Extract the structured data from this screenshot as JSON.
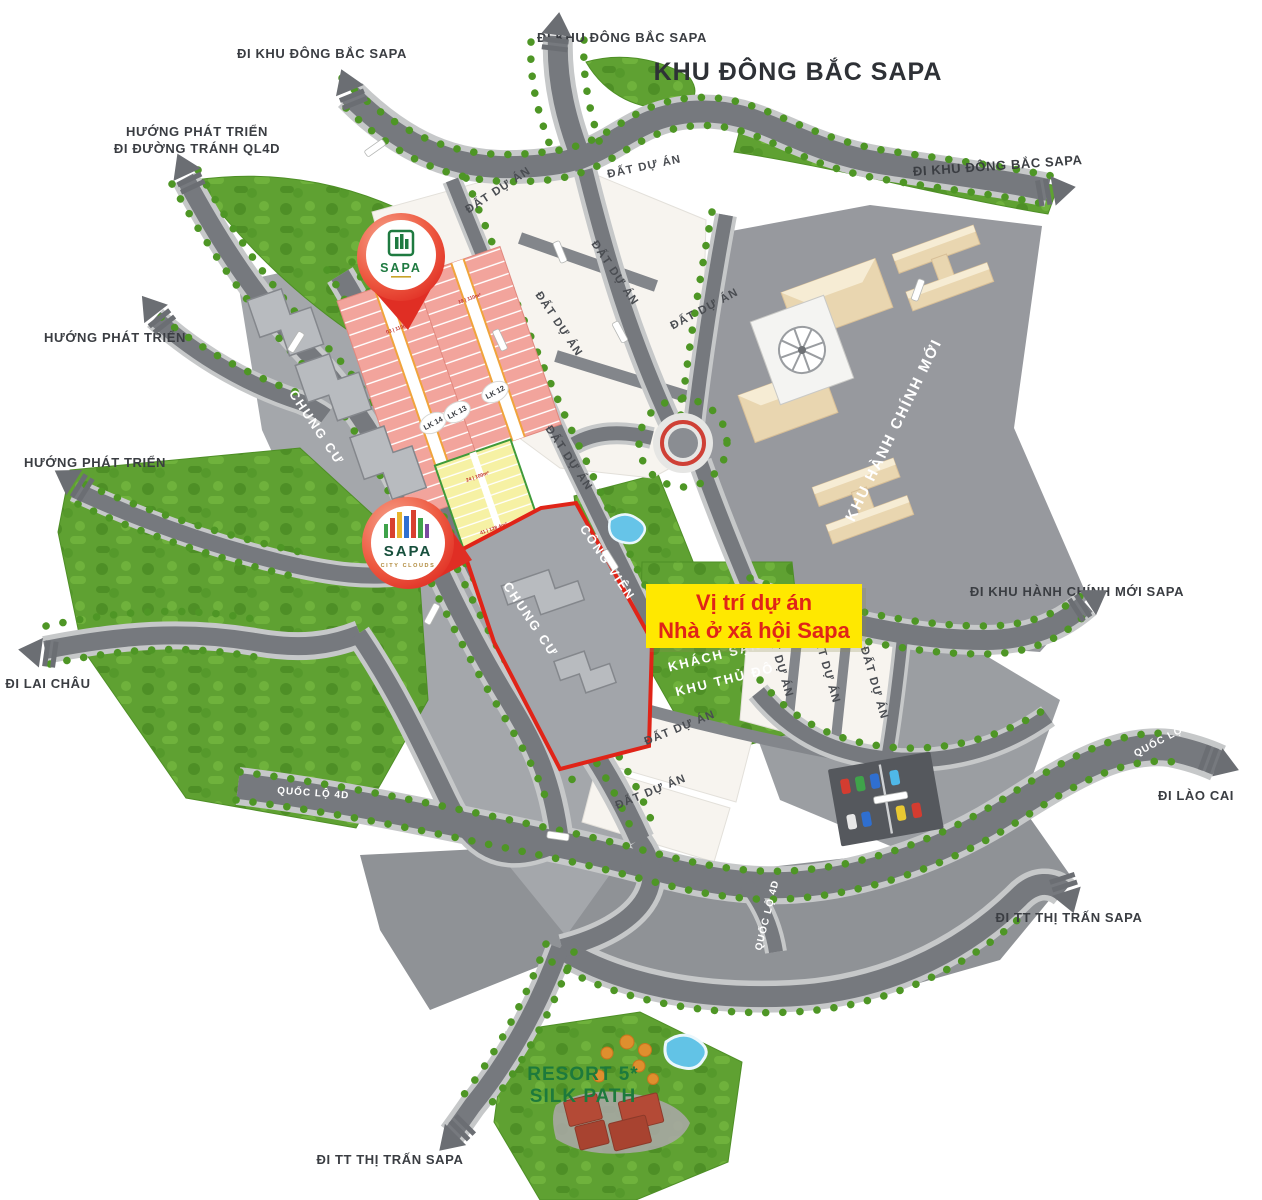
{
  "page_title": "KHU ĐÔNG BẮC SAPA",
  "highlight_box": {
    "line1": "Vị trí dự án",
    "line2": "Nhà ở xã hội Sapa"
  },
  "road_labels": {
    "di_khu_dong_bac_sapa": "ĐI KHU ĐÔNG BẮC SAPA",
    "huong_phat_trien": "HƯỚNG PHÁT TRIỂN",
    "di_duong_tranh_ql4d": "ĐI ĐƯỜNG TRÁNH QL4D",
    "di_lai_chau": "ĐI LAI CHÂU",
    "di_khu_hanh_chinh_moi_sapa": "ĐI KHU HÀNH CHÍNH MỚI SAPA",
    "quoc_lo_4d": "QUỐC LỘ 4D",
    "di_lao_cai": "ĐI LÀO CAI",
    "di_tt_thi_tran_sapa": "ĐI TT THỊ TRẤN SAPA"
  },
  "area_labels": {
    "khu_hanh_chinh_moi": "KHU HÀNH CHÍNH MỚI",
    "chung_cu": "CHUNG CƯ",
    "cong_vien": "CÔNG VIÊN",
    "dat_du_an": "ĐẤT DỰ ÁN",
    "khach_san_line1": "KHÁCH SẠN",
    "khach_san_line2": "KHU THỦ ĐÔ"
  },
  "lot_blocks": {
    "lk12": "LK 12",
    "lk13": "LK 13",
    "lk14": "LK 14",
    "sample_lot_labels": [
      "03 | 110m²",
      "19 | 110m²",
      "24 | 100m²",
      "41 | 128.4m²"
    ]
  },
  "pins": {
    "top": {
      "brand": "SAPA"
    },
    "city_clouds": {
      "brand": "SAPA",
      "tagline": "CITY CLOUDS"
    }
  },
  "resort_label": {
    "line1": "RESORT 5*",
    "line2": "SILK PATH"
  },
  "colors": {
    "pin_red": "#e8453a",
    "highlight_yellow": "#ffe800",
    "highlight_text_red": "#e02418",
    "forest_green": "#5fa132",
    "road_gray": "#76797e",
    "zone_gray": "#95989d",
    "lot_pink": "#f2a49c",
    "lot_yellow": "#f6f1a4",
    "resort_text_green": "#1d7a3c",
    "building_beige": "#e9d6b0",
    "pool_blue": "#62c3e6"
  }
}
